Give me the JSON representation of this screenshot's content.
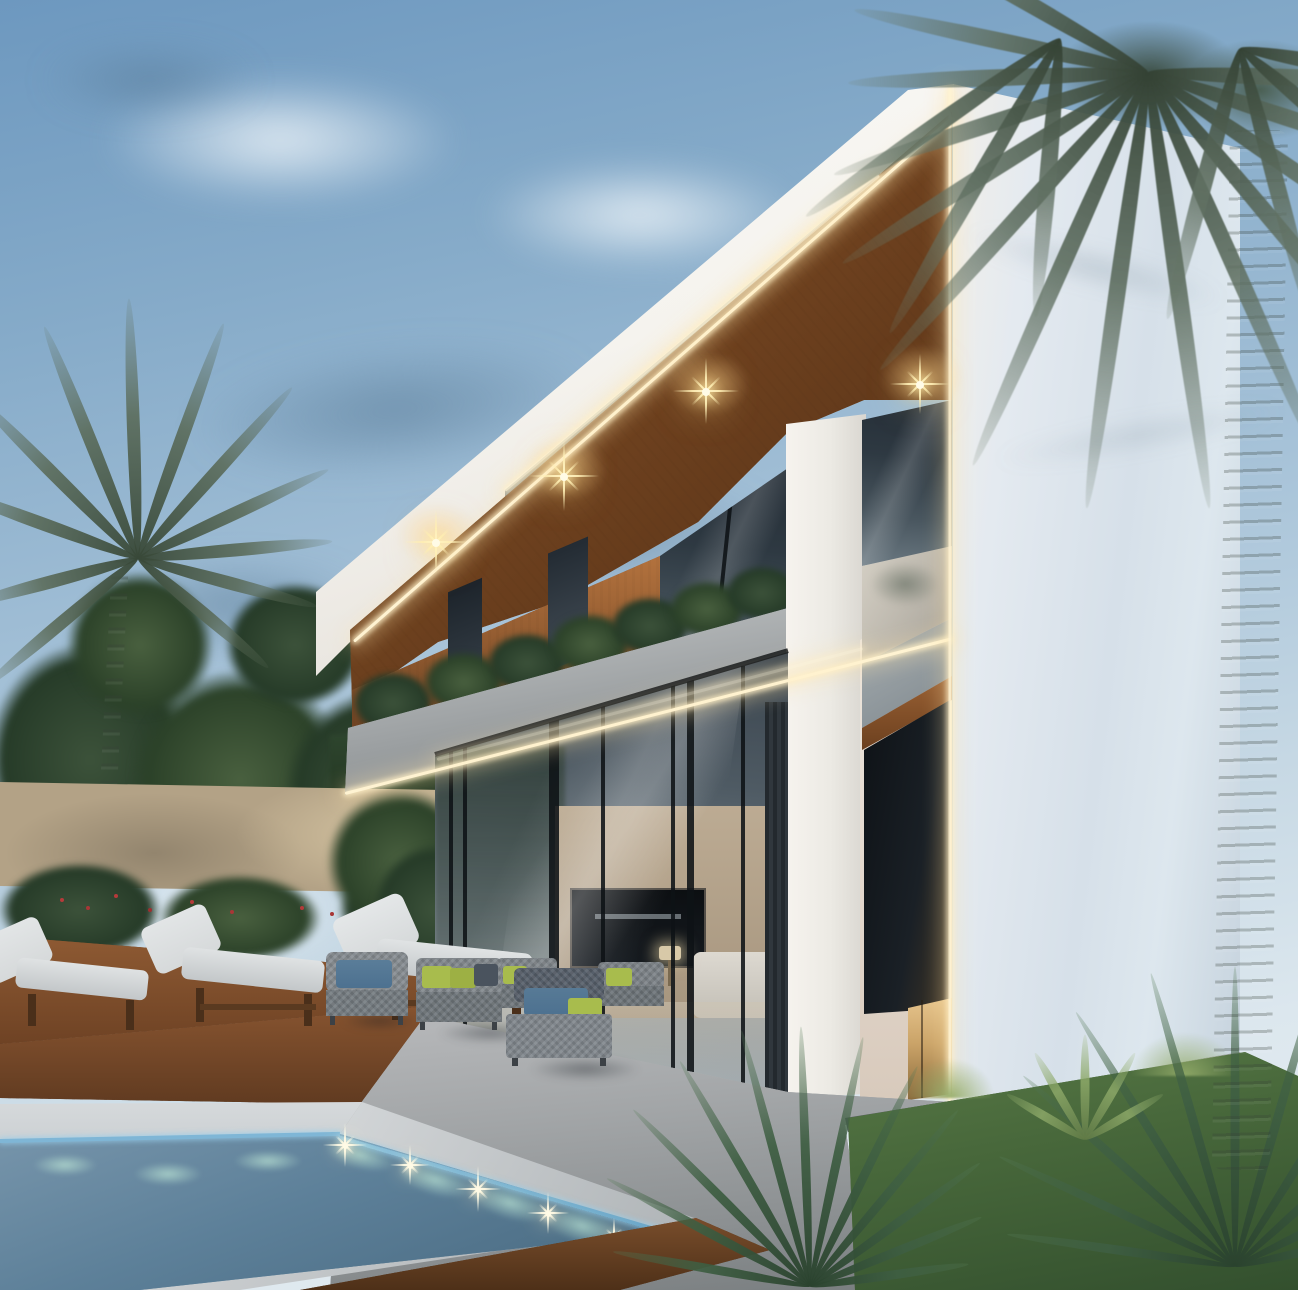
{
  "scene": {
    "type": "3d-architectural-rendering",
    "description": "Modern two-storey villa backyard at dusk: illuminated timber soffits with starburst downlights, LED strip edge lighting, glass curtain walls, stone-clad planter balcony, raised swimming pool with underwater lights, timber deck with sun loungers, grey wicker lounge set, stone perimeter wall, tropical palms, cycads and lawn",
    "time_of_day": "dusk",
    "weather": "partly cloudy"
  },
  "building": {
    "floors": 2,
    "materials": [
      "white plaster",
      "timber slats",
      "grey stone",
      "dark framed glass"
    ],
    "soffit_downlights": 4,
    "led_strips": 5,
    "balcony_planter": true,
    "entry_door_glow": true
  },
  "pool": {
    "raised": true,
    "coping": "light concrete",
    "base_cladding": "timber slats",
    "underwater_lights": 7,
    "surface_sparkles": 5
  },
  "furniture": {
    "sun_loungers": 3,
    "lounge_seats": 5,
    "cushion_colors": [
      "grey",
      "green",
      "blue",
      "charcoal"
    ]
  },
  "vegetation": {
    "palm_trees": 2,
    "cycads": 2,
    "hedges": true,
    "lawn": true,
    "red_flowers": true
  },
  "palette": {
    "sky-top": "#6d98bf",
    "sky-mid": "#a6c2d8",
    "sky-low": "#dce7ee",
    "fascia-white": "#f5f3ee",
    "wall-side": "#dde7ee",
    "wood": "#96613a",
    "wood-dark": "#5e3a20",
    "soffit": "#7c4a24",
    "stone": "#98a0a5",
    "glass": "#2e3942",
    "led": "#fff3d2",
    "star": "#ffeab0",
    "stone-wall": "#b3a286",
    "foliage": "#3c523a",
    "foliage-dark": "#263b28",
    "grass": "#4f7040",
    "water": "#5d8099",
    "waterline": "#7fb6d6",
    "coping": "#cbd0d3",
    "deck": "#7b4b29",
    "cushion": "#d6d9da",
    "sofa": "#898f94",
    "pillow-green": "#a8bc4d",
    "pillow-blue": "#4d7190",
    "floor": "#a2a5a7",
    "door-glow": "#e6c48c"
  }
}
